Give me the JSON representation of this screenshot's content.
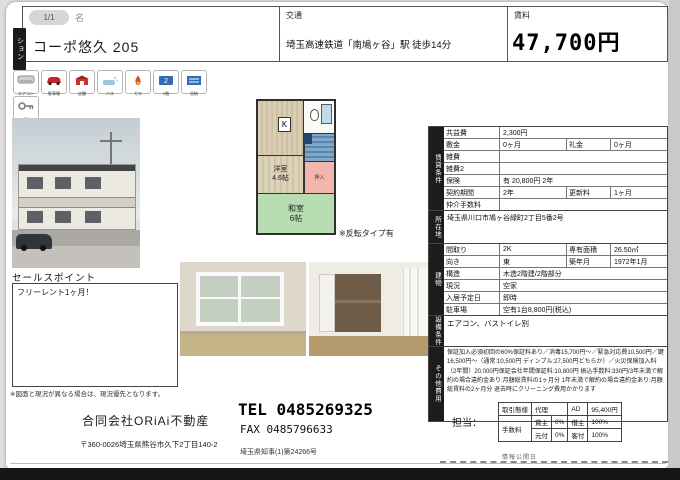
{
  "header": {
    "page_badge": "1/1",
    "name_fragment": "名",
    "type_tab": "ション",
    "property_name": "コーポ悠久 205",
    "transport_label": "交通",
    "transport_value": "埼玉高速鉄道「南鳩ヶ谷」駅 徒歩14分",
    "rent_label": "賃料",
    "rent_value": "47,700円"
  },
  "amenities": {
    "labels": [
      "エアコン",
      "駐車場",
      "店舗",
      "バス",
      "ガス",
      "2階",
      "収納",
      "鍵"
    ]
  },
  "floorplan": {
    "kitchen": "K",
    "western_name": "洋室",
    "western_size": "4.6帖",
    "closet": "押入",
    "japanese_name": "和室",
    "japanese_size": "6帖",
    "note": "※反転タイプ有"
  },
  "sales": {
    "title": "セールスポイント",
    "text": "フリーレント1ヶ月！"
  },
  "disclaimer": "※図面と現況が異なる場合は、現況優先となります。",
  "sections": {
    "conditions": "賃貸条件",
    "location": "所在地",
    "building": "建物",
    "equipment": "設備条件",
    "other": "その他費用"
  },
  "conditions": {
    "rows": [
      {
        "label": "共益費",
        "value": "2,300円"
      },
      {
        "label": "敷金",
        "value": "0ヶ月",
        "label2": "礼金",
        "value2": "0ヶ月"
      },
      {
        "label": "雑費",
        "value": ""
      },
      {
        "label": "雑費2",
        "value": ""
      },
      {
        "label": "保険",
        "value": "有 20,800円 2年"
      },
      {
        "label": "契約期間",
        "value": "2年",
        "label2": "更新料",
        "value2": "1ヶ月"
      },
      {
        "label": "仲介手数料",
        "value": ""
      }
    ]
  },
  "location": {
    "address": "埼玉県川口市鳩ヶ谷緑町2丁目5番2号"
  },
  "building": {
    "rows": [
      {
        "label": "間取り",
        "value": "2K",
        "label2": "専有面積",
        "value2": "26.50㎡"
      },
      {
        "label": "向き",
        "value": "東",
        "label2": "築年月",
        "value2": "1972年1月"
      },
      {
        "label": "構造",
        "value": "木造2階建/2階部分"
      },
      {
        "label": "現況",
        "value": "空家"
      },
      {
        "label": "入居予定日",
        "value": "即時"
      },
      {
        "label": "駐車場",
        "value": "空有1台8,800円(税込)"
      }
    ]
  },
  "equipment": "エアコン、バストイレ別",
  "other_costs": "保証加入必須初回の60%保証料あり／消毒15,700円〜／緊急対応費10,500円／鍵16,500円〜（通常:10,500円 ディンプル:27,500円どちらか）／火災保険加入料（2年間）20,000円保証会社年間保証料:10,800円 振込手数料:330円/3年未満で解約の場合違約金あり:月額総賃料の1ヶ月分 1年未満で解約の場合違約金あり:月額総賃料の2ヶ月分 退去時にクリーニング費用かかります",
  "footer": {
    "company": "合同会社ORiAi不動産",
    "tel": "TEL 0485269325",
    "fax": "FAX 0485796633",
    "address": "〒360-0026埼玉県熊谷市久下2丁目140-2",
    "license": "埼玉県知事(1)第24266号",
    "staff_label": "担当：",
    "deal": {
      "type_label": "取引態様",
      "type_value": "代理",
      "ad_label": "AD",
      "ad_value": "95,400円",
      "fee_label": "手数料",
      "landlord_label": "貸主",
      "landlord_value": "0%",
      "tenant_label": "借主",
      "tenant_value": "100%",
      "moto_label": "元付",
      "moto_value": "0%",
      "kyaku_label": "客付",
      "kyaku_value": "100%"
    },
    "info_date": "情報公開日"
  },
  "colors": {
    "tatami_green": "#b9ddb2",
    "wood_beige": "#d6cbb0",
    "closet_pink": "#f2b6ae",
    "stairs_blue": "#7fa8c9",
    "section_black": "#1c1c1c"
  }
}
